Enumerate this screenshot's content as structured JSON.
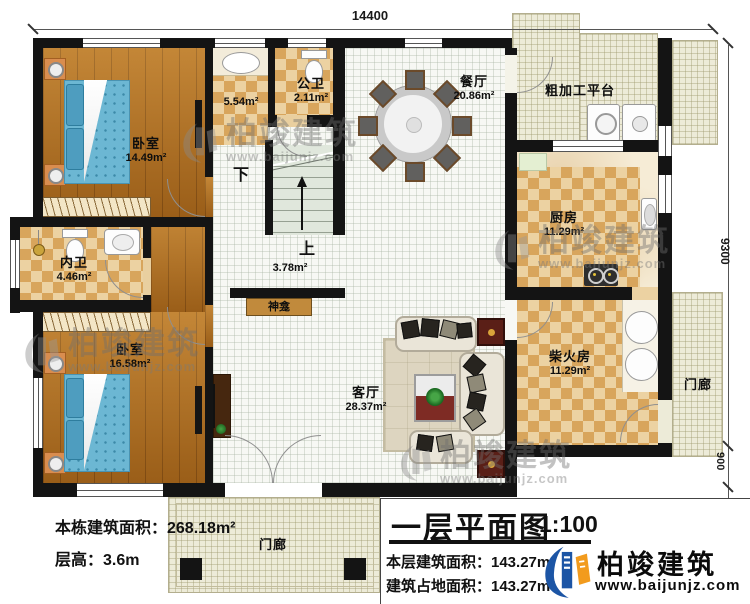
{
  "dims": {
    "width_top": "14400",
    "height_right": "9300",
    "porch_right_depth": "900",
    "porch_front_depth": "2000"
  },
  "rooms": {
    "bedroom1": {
      "name": "卧室",
      "area": "14.49m²"
    },
    "washroom": {
      "area": "5.54m²"
    },
    "public_wc": {
      "name": "公卫",
      "area": "2.11m²"
    },
    "dining": {
      "name": "餐厅",
      "area": "20.86m²"
    },
    "platform": {
      "name": "粗加工平台"
    },
    "kitchen": {
      "name": "厨房",
      "area": "11.29m²"
    },
    "inner_wc": {
      "name": "内卫",
      "area": "4.46m²"
    },
    "bedroom2": {
      "name": "卧室",
      "area": "16.58m²"
    },
    "living": {
      "name": "客厅",
      "area": "28.37m²"
    },
    "firewood": {
      "name": "柴火房",
      "area": "11.29m²"
    },
    "porch_right": {
      "name": "门廊"
    },
    "porch_front": {
      "name": "门廊"
    },
    "shrine": {
      "name": "神龛"
    },
    "stair_hall": {
      "area": "3.78m²"
    },
    "stairs": {
      "down": "下",
      "up": "上"
    }
  },
  "notes": {
    "building_total_area": "本栋建筑面积：268.18m²",
    "floor_height": "层高：3.6m"
  },
  "title_block": {
    "title": "一层平面图",
    "scale": "1:100",
    "floor_area": "本层建筑面积：143.27m²",
    "footprint_area": "建筑占地面积：143.27m²"
  },
  "brand": {
    "name": "柏竣建筑",
    "url": "www.baijunjz.com"
  },
  "colors": {
    "brand_blue": "#1c55a5",
    "brand_orange": "#f29b1d",
    "wall": "#141414",
    "wood_floor": "#b3701f",
    "checker_dark": "#d8a55c",
    "cream_tile": "#edebd8"
  }
}
